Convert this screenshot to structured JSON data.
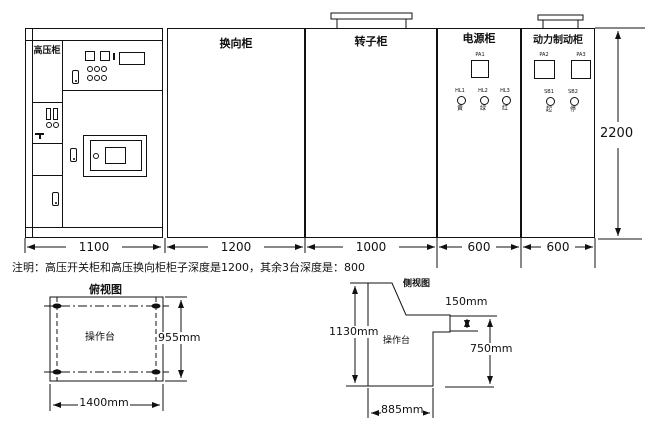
{
  "elevation": {
    "cabinets": [
      {
        "name": "高压柜",
        "width": "1100"
      },
      {
        "name": "换向柜",
        "width": "1200"
      },
      {
        "name": "转子柜",
        "width": "1000"
      },
      {
        "name": "电源柜",
        "width": "600"
      },
      {
        "name": "动力制动柜",
        "width": "600"
      }
    ],
    "overall_height": "2200",
    "power_cabinet": {
      "meter": "PA1",
      "lamps": [
        {
          "tag": "HL1",
          "char": "黄"
        },
        {
          "tag": "HL2",
          "char": "绿"
        },
        {
          "tag": "HL3",
          "char": "红"
        }
      ]
    },
    "brake_cabinet": {
      "meters": [
        {
          "tag": "PA2"
        },
        {
          "tag": "PA3"
        }
      ],
      "buttons": [
        {
          "tag": "SB1",
          "char": "起"
        },
        {
          "tag": "SB2",
          "char": "停"
        }
      ]
    }
  },
  "note": "注明：高压开关柜和高压换向柜柜子深度是1200，其余3台深度是：800",
  "top_view": {
    "title": "俯视图",
    "label": "操作台",
    "width_dim": "1400mm",
    "depth_dim": "955mm"
  },
  "side_view": {
    "title": "侧视图",
    "label": "操作台",
    "height_dim": "1130mm",
    "depth_dim": "885mm",
    "shelf_dim": "150mm",
    "desk_dim": "750mm"
  }
}
